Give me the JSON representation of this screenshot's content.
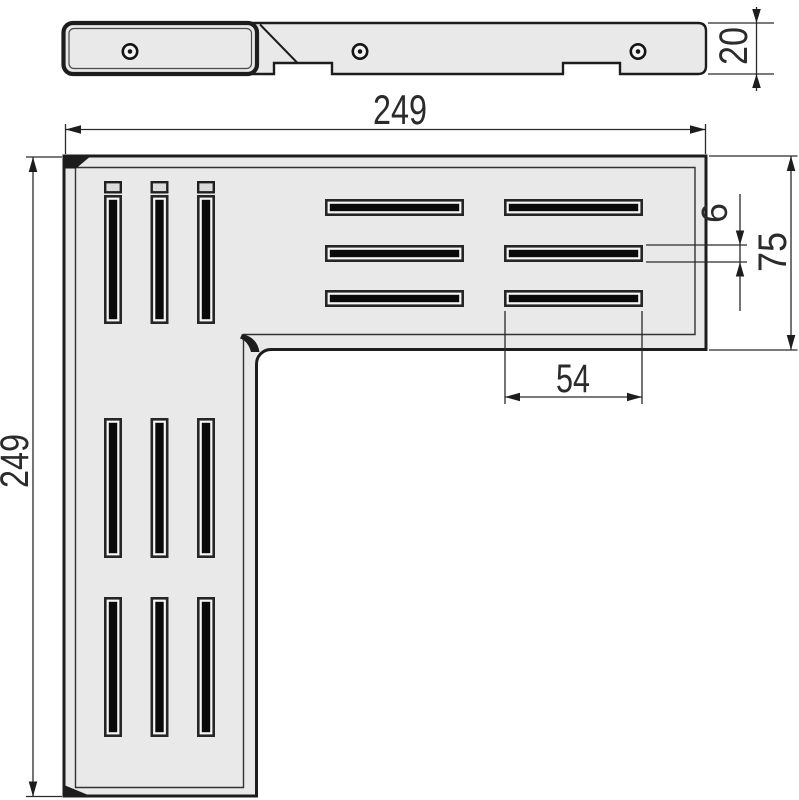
{
  "drawing": {
    "description": "Technical CAD drawing of an L-shaped corner drain grate: side profile view on top, plan view below, with linear dimensions",
    "dimensions": {
      "top_width": "249",
      "left_height": "249",
      "profile_thickness": "20",
      "arm_width": "75",
      "slot_width": "6",
      "slot_length": "54"
    },
    "colors": {
      "background": "#ffffff",
      "line": "#1d1d1d",
      "plate_fill": "#e9e9e9",
      "slot_fill": "#0a0a0a",
      "slot_rim": "#f6f6f6",
      "label": "#2b2b2b"
    },
    "side_view": {
      "screw_holes": 3,
      "bottom_notches": 2
    },
    "plan_view": {
      "vertical_slot_groups": 3,
      "vertical_slots_per_group": 3,
      "horizontal_slot_columns": 2,
      "horizontal_slot_rows": 3
    }
  }
}
